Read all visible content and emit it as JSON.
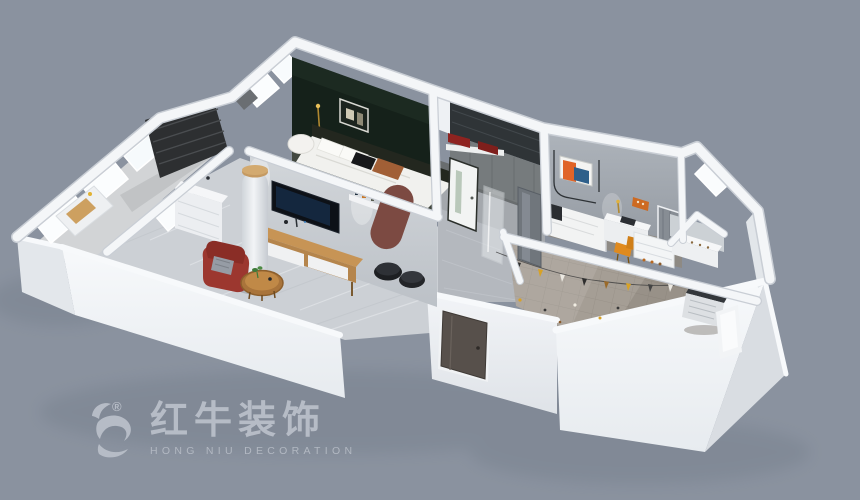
{
  "watermark": {
    "brand_cn": "红牛装饰",
    "brand_en": "HONG NIU DECORATION",
    "registered": "®",
    "icon": "bull-icon"
  },
  "palette": {
    "background": "#8a929f",
    "wall_light": "#f4f6f8",
    "wall_shade": "#d9dde2",
    "accent_wall_green": "#15211a",
    "floor_marble": "#ccd0d5",
    "floor_tile_terrace": "#a59e95",
    "bathroom_tile_dark": "#2f3437",
    "armchair_red": "#9c372f",
    "arch_maroon": "#7c4a42",
    "art_orange": "#e06428",
    "art_blue": "#2e5f8a",
    "wood": "#b5854c",
    "watermark_gray": "#b6bcc6"
  }
}
